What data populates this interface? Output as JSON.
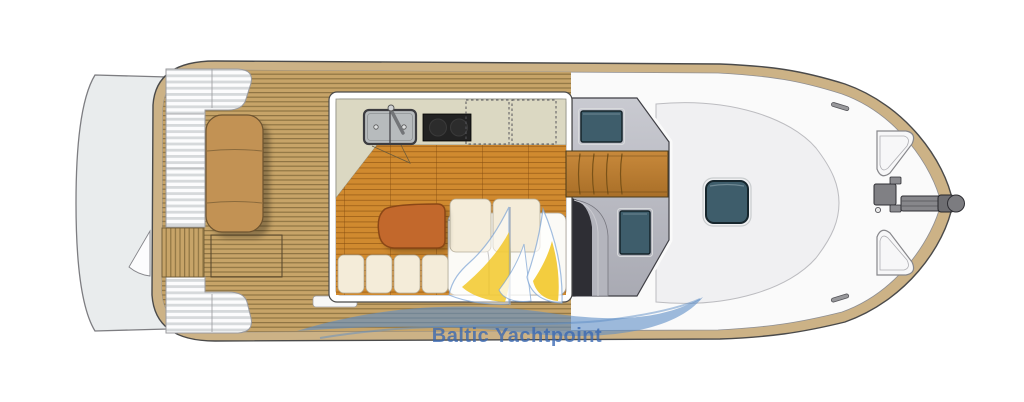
{
  "meta": {
    "figure_type": "motor yacht deck and accommodation plan, top view, bow to the right",
    "canvas_width": 1024,
    "canvas_height": 402
  },
  "watermark": {
    "brand_text": "Baltic Yachtpoint",
    "logo": "sailboat-sails-with-wave-icon"
  },
  "palette": {
    "hull_rim": "#ccb286",
    "deck_white": "#fafafa",
    "deck_teak": "#c7a468",
    "teak_seam": "#8f7443",
    "platform_white": "#e9eced",
    "stripe_pad": "#d6d9db",
    "salon_floor": "#d08a2f",
    "galley_counter": "#dbd8c2",
    "cushion_cream": "#f4ecd9",
    "table_wood": "#c2682c",
    "sunpad_tan": "#c29254",
    "coachroof_gray": "#b9bac1",
    "hatch_glass": "#3e5d6b",
    "stove_black": "#222222",
    "sink_gray": "#b7bbbd",
    "logo_blue": "#5d8dc6",
    "logo_yellow": "#f1c41d",
    "logo_text_blue": "#3868b2"
  },
  "plan": {
    "stern": {
      "swim_platform": 1,
      "transom_gate": 1,
      "gate_swing_arc": 1
    },
    "aft_deck": {
      "surface": "teak planks",
      "striped_corner_pads": 2,
      "sunpad_seat": 1,
      "deck_hatch": 1
    },
    "salon": {
      "galley": {
        "sink_bowls": 2,
        "faucet": 1,
        "stove_burners": 2,
        "overhead_lockers_dashed": 2
      },
      "settee_cushions": 4,
      "back_cushions": 2,
      "chaise_platform": 1,
      "table": 1
    },
    "coachroof": {
      "roof_hatches": 2,
      "wood_step_pad": 1,
      "companionway": 1
    },
    "foredeck": {
      "center_hatch": 1,
      "bow_triangle_hatches": 2,
      "cleats": 2,
      "windlass": 1,
      "anchor_roller": 1
    }
  }
}
